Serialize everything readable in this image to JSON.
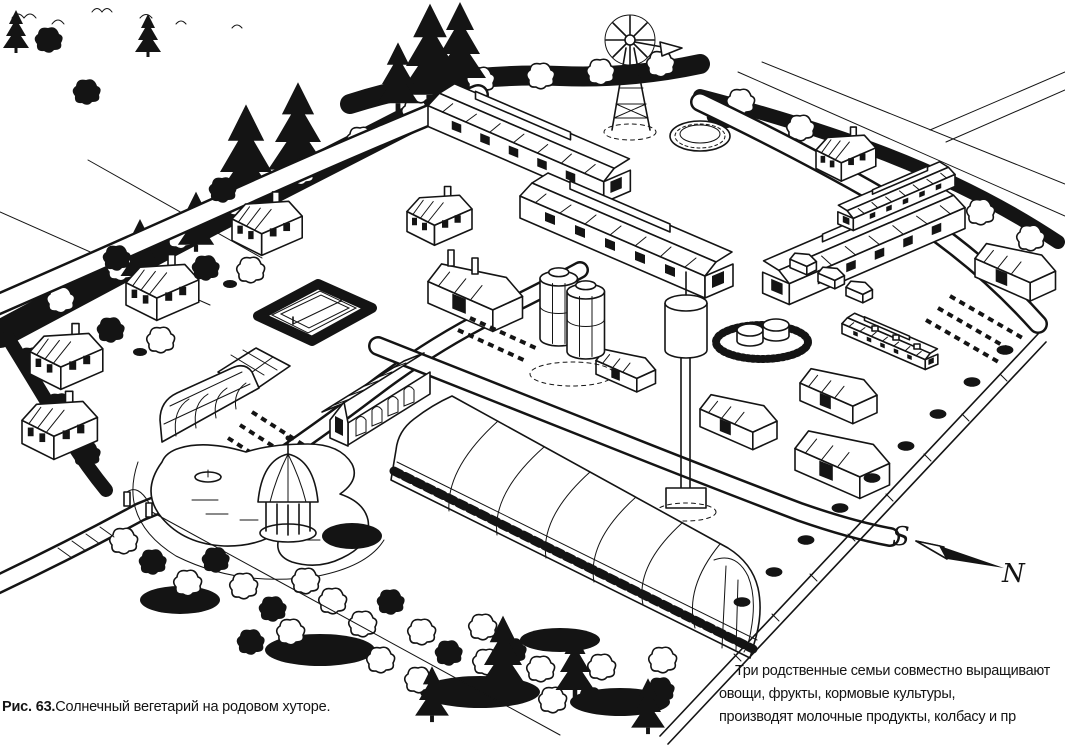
{
  "figure_caption": {
    "label": "Рис. 63.",
    "title": "Солнечный вегетарий на родовом хуторе."
  },
  "annotation": {
    "lines": [
      "Три родственные семьи совместно выращивают",
      "овощи, фрукты, кормовые культуры,",
      "производят молочные продукты, колбасу и пр"
    ]
  },
  "compass": {
    "south": "S",
    "north": "N"
  },
  "palette": {
    "ink": "#141414",
    "paper": "#ffffff"
  },
  "scene_elements": [
    "windmill",
    "solar-vegetarium-greenhouse",
    "small-greenhouse",
    "conservatory",
    "cold-frames",
    "residential-houses",
    "long-barns",
    "farmyard-complex",
    "silos",
    "water-tower",
    "feed-tanks",
    "round-tank",
    "sheds",
    "hutch-row",
    "tennis-court",
    "pond",
    "boat",
    "gazebo",
    "orchard",
    "hedges",
    "roads",
    "entrance-gate",
    "perimeter-fence",
    "compass-needle"
  ]
}
